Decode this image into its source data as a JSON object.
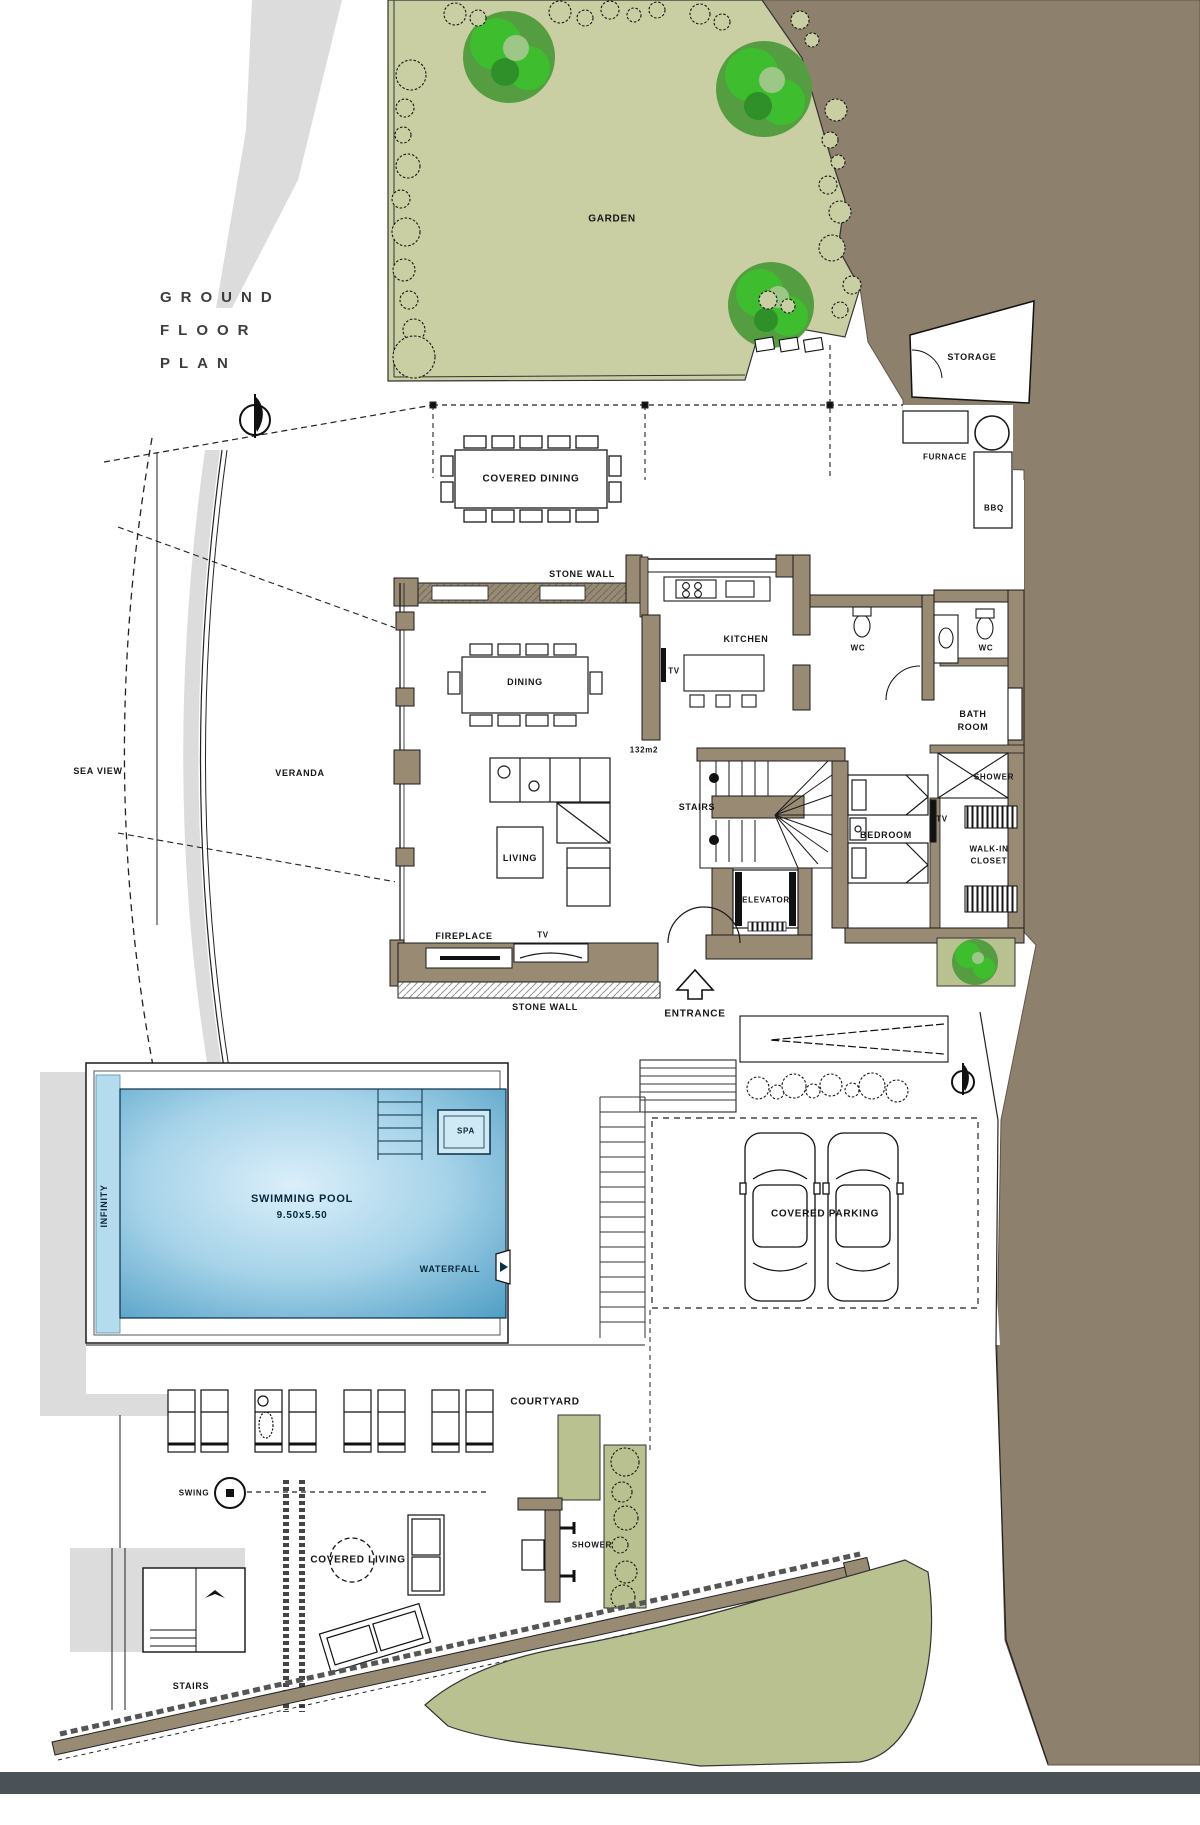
{
  "title": {
    "line1": "GROUND",
    "line2": "FLOOR",
    "line3": "PLAN"
  },
  "labels": {
    "garden": "GARDEN",
    "storage": "STORAGE",
    "furnace": "FURNACE",
    "bbq": "BBQ",
    "covered_dining": "COVERED DINING",
    "stone_wall": "STONE WALL",
    "kitchen": "KITCHEN",
    "wc": "WC",
    "bathroom_line1": "BATH",
    "bathroom_line2": "ROOM",
    "dining": "DINING",
    "sea_view": "SEA VIEW",
    "veranda": "VERANDA",
    "floor_area": "132m2",
    "stairs": "STAIRS",
    "elevator": "ELEVATOR",
    "bedroom": "BEDROOM",
    "tv": "TV",
    "shower": "SHOWER",
    "walk_in_line1": "WALK-IN",
    "walk_in_line2": "CLOSET",
    "living": "LIVING",
    "fireplace": "FIREPLACE",
    "entrance": "ENTRANCE",
    "swimming_pool": "SWIMMING POOL",
    "pool_size": "9.50x5.50",
    "infinity": "INFINITY",
    "spa": "SPA",
    "waterfall": "WATERFALL",
    "covered_parking": "COVERED PARKING",
    "courtyard": "COURTYARD",
    "swing": "SWING",
    "covered_living": "COVERED LIVING"
  },
  "colors": {
    "wall": "#998a74",
    "garden": "#c9cfa3",
    "terrain": "#8d806d",
    "tree": "#3ebd2e",
    "pool_center": "#dbeffa",
    "pool_edge": "#4e9dc4",
    "road": "#4a5157",
    "shadow": "#dcdcdc"
  }
}
